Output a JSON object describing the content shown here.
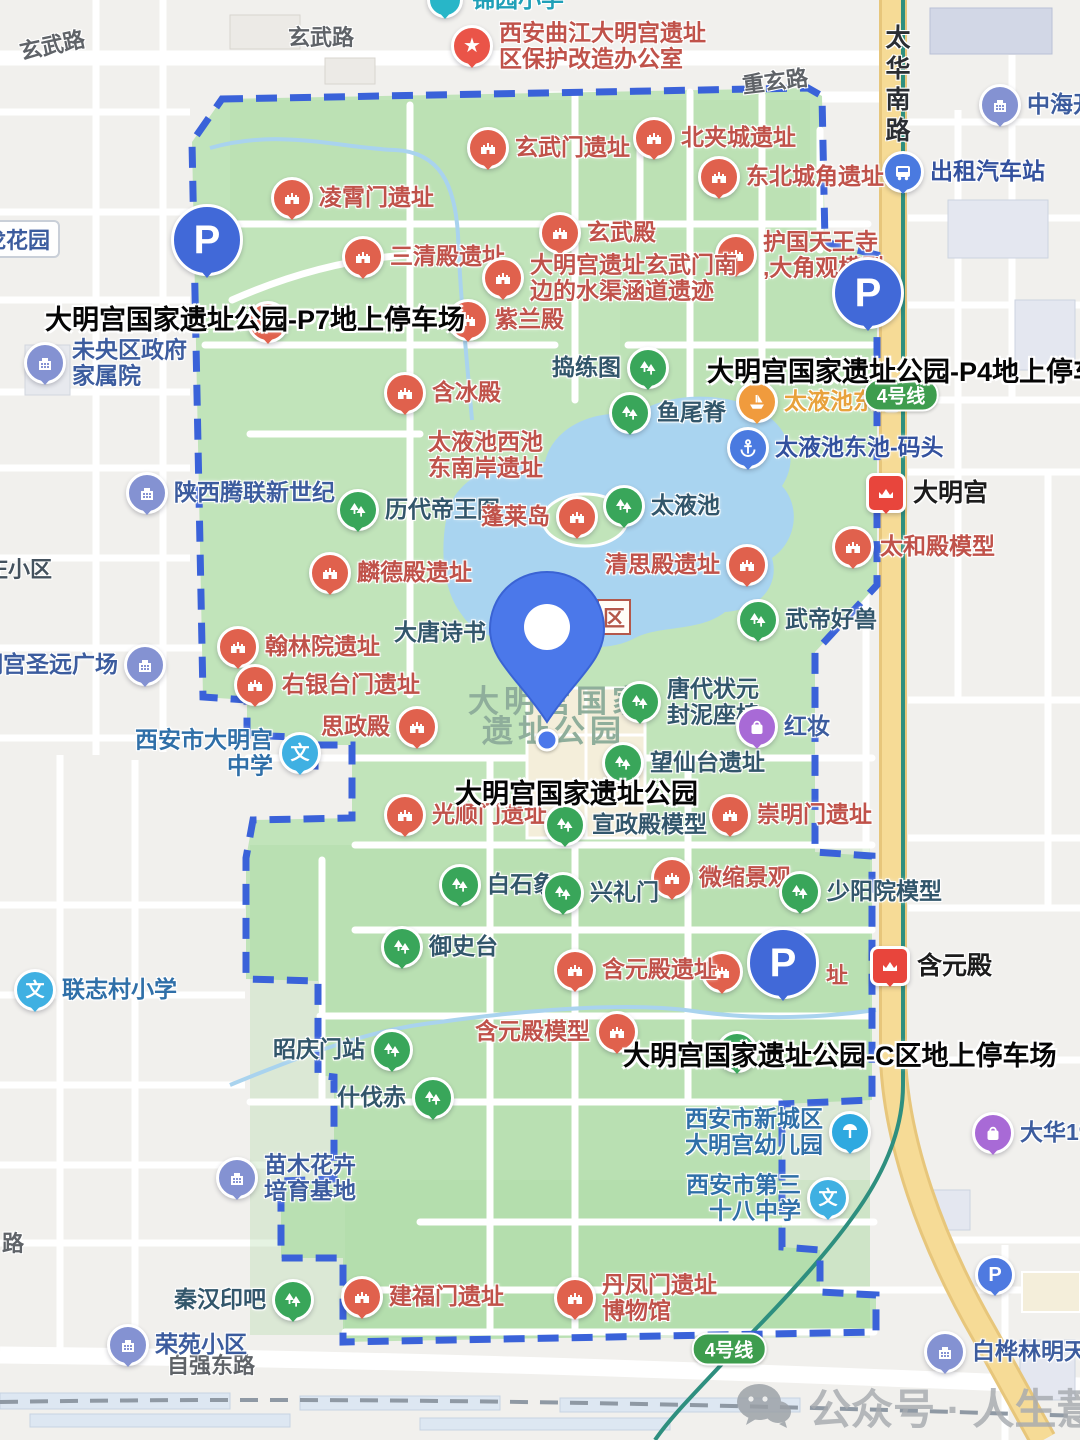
{
  "map_title": "大明宫国家遗址公园地图",
  "colors": {
    "park_green": "#c1e4ba",
    "border_blue": "#3a62d9",
    "water": "#a9d4f0",
    "road_yellow": "#f6db96",
    "metro_teal": "#2e8f7f",
    "badge_green": "#3e9d4e",
    "ruin_pin": "#e0614d",
    "scenic_pin": "#39a65a",
    "parking_pin": "#4169d8"
  },
  "location_pin": {
    "x": 547,
    "y": 632,
    "tip_x": 547,
    "tip_y": 722,
    "dot_x": 547,
    "dot_y": 740
  },
  "area_label": {
    "line1": "大明宫国家",
    "line2": "遗址公园",
    "x1": 468,
    "y1": 676,
    "x2": 482,
    "y2": 706
  },
  "bold_labels": [
    {
      "id": "p7-parking-name",
      "text": "大明宫国家遗址公园-P7地上停车场",
      "x": 45,
      "y": 298
    },
    {
      "id": "p4-parking-name",
      "text": "大明宫国家遗址公园-P4地上停车场",
      "x": 707,
      "y": 350
    },
    {
      "id": "park-name",
      "text": "大明宫国家遗址公园",
      "x": 455,
      "y": 772
    },
    {
      "id": "c-parking-name",
      "text": "大明宫国家遗址公园-C区地上停车场",
      "x": 623,
      "y": 1034
    }
  ],
  "road_labels": [
    {
      "id": "xuanwu-rd-west",
      "text": "玄武路",
      "x": 19,
      "y": 28,
      "rot": -12
    },
    {
      "id": "xuanwu-rd-center",
      "text": "玄武路",
      "x": 288,
      "y": 20,
      "rot": 0
    },
    {
      "id": "chongxuan-rd",
      "text": "重玄路",
      "x": 742,
      "y": 64,
      "rot": -7
    },
    {
      "id": "taihua-south-rd",
      "text": "太华南路",
      "x": 878,
      "y": 24,
      "vertical": true
    },
    {
      "id": "ziqiang-east-rd",
      "text": "自强东路",
      "x": 167,
      "y": 1348,
      "rot": 0
    },
    {
      "id": "road-fragment",
      "text": "路",
      "x": 2,
      "y": 1226,
      "rot": 0
    }
  ],
  "badges": [
    {
      "id": "line4-badge-north",
      "text": "4号线",
      "x": 901,
      "y": 395
    },
    {
      "id": "line4-badge-south",
      "text": "4号线",
      "x": 729,
      "y": 1349
    }
  ],
  "fragments": [
    {
      "id": "scenic-zone-fragment",
      "text": "区",
      "x": 597,
      "y": 599,
      "boxed": true
    },
    {
      "id": "covered-ruin-fragment",
      "text": "址",
      "x": 826,
      "y": 958,
      "boxed": false
    }
  ],
  "edge_labels": [
    {
      "id": "longhuayuan",
      "text": "龙花园",
      "x": -26,
      "y": 220,
      "boxed": true
    },
    {
      "id": "zhuang-xiaoqu",
      "text": "庄小区",
      "x": -14,
      "y": 552,
      "boxed": false
    }
  ],
  "watermark": {
    "text": "公众号 · 人生薏林",
    "x": 735,
    "y": 1376
  },
  "pois": [
    {
      "id": "jinyuan-primary-school",
      "t": "cyan",
      "x": 445,
      "y": 0,
      "s": "right",
      "l": [
        "锦园小学"
      ]
    },
    {
      "id": "daminggong-protection-office",
      "t": "star",
      "x": 472,
      "y": 46,
      "s": "right",
      "l": [
        "西安曲江大明宫遗址",
        "区保护改造办公室"
      ]
    },
    {
      "id": "zhonghai-kai",
      "t": "building",
      "x": 1000,
      "y": 105,
      "s": "right",
      "l": [
        "中海开"
      ]
    },
    {
      "id": "taxi-station",
      "t": "bus",
      "x": 903,
      "y": 172,
      "s": "right",
      "l": [
        "出租汽车站"
      ]
    },
    {
      "id": "beijiacheng-ruins",
      "t": "ruin",
      "x": 654,
      "y": 138,
      "s": "right",
      "l": [
        "北夹城遗址"
      ]
    },
    {
      "id": "northeast-corner-ruins",
      "t": "ruin",
      "x": 719,
      "y": 177,
      "s": "right",
      "l": [
        "东北城角遗址"
      ]
    },
    {
      "id": "xuanwumen-ruins",
      "t": "ruin",
      "x": 488,
      "y": 148,
      "s": "right",
      "l": [
        "玄武门遗址"
      ]
    },
    {
      "id": "lingxiaomen-ruins",
      "t": "ruin",
      "x": 292,
      "y": 198,
      "s": "right",
      "l": [
        "凌霄门遗址"
      ]
    },
    {
      "id": "xuanwu-hall",
      "t": "ruin",
      "x": 560,
      "y": 233,
      "s": "right",
      "l": [
        "玄武殿"
      ]
    },
    {
      "id": "sanqing-hall-ruins",
      "t": "ruin",
      "x": 363,
      "y": 257,
      "s": "right",
      "l": [
        "三清殿遗址"
      ]
    },
    {
      "id": "huguo-tianwang-temple",
      "t": "ruin",
      "x": 736,
      "y": 255,
      "s": "right",
      "l": [
        "护国天王寺",
        ",大角观模型"
      ]
    },
    {
      "id": "water-channel-ruins",
      "t": "ruin",
      "x": 503,
      "y": 278,
      "s": "right",
      "l": [
        "大明宫遗址玄武门南",
        "边的水渠涵道遗迹"
      ]
    },
    {
      "id": "zilan-hall",
      "t": "ruin",
      "x": 468,
      "y": 320,
      "s": "right",
      "l": [
        "紫兰殿"
      ]
    },
    {
      "id": "hidden-ruin-p7",
      "t": "ruin",
      "x": 268,
      "y": 322,
      "s": "none",
      "l": [],
      "hidden": true
    },
    {
      "id": "hanbing-hall",
      "t": "ruin",
      "x": 405,
      "y": 393,
      "s": "right",
      "l": [
        "含冰殿"
      ]
    },
    {
      "id": "weiyang-gov-compound",
      "t": "building",
      "x": 45,
      "y": 363,
      "s": "right",
      "l": [
        "未央区政府",
        "家属院"
      ]
    },
    {
      "id": "daolian-painting",
      "t": "scenic",
      "x": 648,
      "y": 368,
      "s": "left",
      "l": [
        "捣练图"
      ]
    },
    {
      "id": "yuweiji",
      "t": "scenic",
      "x": 630,
      "y": 413,
      "s": "right",
      "l": [
        "鱼尾脊"
      ]
    },
    {
      "id": "taiye-east-pool",
      "t": "boat",
      "x": 757,
      "y": 402,
      "s": "right",
      "l": [
        "太液池东池"
      ]
    },
    {
      "id": "taiye-east-pool-pier",
      "t": "anchor",
      "x": 748,
      "y": 448,
      "s": "right",
      "l": [
        "太液池东池-码头"
      ]
    },
    {
      "id": "daminggong-metro",
      "t": "metro",
      "x": 886,
      "y": 493,
      "s": "right",
      "l": [
        "大明宫"
      ]
    },
    {
      "id": "shanxi-tenglian",
      "t": "building",
      "x": 147,
      "y": 493,
      "s": "right",
      "l": [
        "陕西腾联新世纪"
      ]
    },
    {
      "id": "emperors-painting",
      "t": "scenic",
      "x": 358,
      "y": 510,
      "s": "right",
      "l": [
        "历代帝王图"
      ]
    },
    {
      "id": "penglai-island",
      "t": "ruin",
      "x": 577,
      "y": 517,
      "s": "left",
      "l": [
        "蓬莱岛"
      ]
    },
    {
      "id": "taiye-pool",
      "t": "scenic",
      "x": 624,
      "y": 506,
      "s": "right",
      "l": [
        "太液池"
      ]
    },
    {
      "id": "taiye-west-pool-ruins",
      "t": "text",
      "x": 428,
      "y": 455,
      "s": "none",
      "l": [
        "太液池西池",
        "东南岸遗址"
      ],
      "c": "ruin"
    },
    {
      "id": "taihe-hall-model",
      "t": "ruin",
      "x": 853,
      "y": 547,
      "s": "right",
      "l": [
        "太和殿模型"
      ]
    },
    {
      "id": "linde-hall-ruins",
      "t": "ruin",
      "x": 330,
      "y": 573,
      "s": "right",
      "l": [
        "麟德殿遗址"
      ]
    },
    {
      "id": "qingsi-hall-ruins",
      "t": "ruin",
      "x": 747,
      "y": 565,
      "s": "left",
      "l": [
        "清思殿遗址"
      ]
    },
    {
      "id": "wudi-haoshou",
      "t": "scenic",
      "x": 758,
      "y": 620,
      "s": "right",
      "l": [
        "武帝好兽"
      ]
    },
    {
      "id": "datang-poetry",
      "t": "scenic",
      "x": 513,
      "y": 633,
      "s": "left",
      "l": [
        "大唐诗书"
      ],
      "hidden": true
    },
    {
      "id": "hanlin-academy-ruins",
      "t": "ruin",
      "x": 238,
      "y": 647,
      "s": "right",
      "l": [
        "翰林院遗址"
      ]
    },
    {
      "id": "youyintai-gate-ruins",
      "t": "ruin",
      "x": 255,
      "y": 685,
      "s": "right",
      "l": [
        "右银台门遗址"
      ]
    },
    {
      "id": "shengyuan-plaza",
      "t": "building",
      "x": 145,
      "y": 665,
      "s": "left",
      "l": [
        "大明宫圣远广场"
      ]
    },
    {
      "id": "zhuangyuan-seal-seat",
      "t": "scenic",
      "x": 640,
      "y": 702,
      "s": "right",
      "l": [
        "唐代状元",
        "封泥座椅"
      ]
    },
    {
      "id": "sizheng-hall",
      "t": "ruin",
      "x": 417,
      "y": 727,
      "s": "left",
      "l": [
        "思政殿"
      ]
    },
    {
      "id": "hongzhuang-shop",
      "t": "shop",
      "x": 757,
      "y": 727,
      "s": "right",
      "l": [
        "红妆"
      ]
    },
    {
      "id": "wangxiantai-ruins",
      "t": "scenic",
      "x": 623,
      "y": 763,
      "s": "right",
      "l": [
        "望仙台遗址"
      ]
    },
    {
      "id": "daminggong-middle-school",
      "t": "school",
      "x": 300,
      "y": 753,
      "s": "left",
      "l": [
        "西安市大明宫",
        "中学"
      ]
    },
    {
      "id": "guangshunmen-ruins",
      "t": "ruin",
      "x": 405,
      "y": 815,
      "s": "right",
      "l": [
        "光顺门遗址"
      ]
    },
    {
      "id": "chongmingmen-ruins",
      "t": "ruin",
      "x": 730,
      "y": 815,
      "s": "right",
      "l": [
        "崇明门遗址"
      ]
    },
    {
      "id": "xuanzheng-hall-model",
      "t": "scenic",
      "x": 565,
      "y": 825,
      "s": "right",
      "l": [
        "宣政殿模型"
      ]
    },
    {
      "id": "miniature-landscape",
      "t": "ruin",
      "x": 672,
      "y": 878,
      "s": "right",
      "l": [
        "微缩景观"
      ]
    },
    {
      "id": "shaoyangyuan-model",
      "t": "scenic",
      "x": 800,
      "y": 892,
      "s": "right",
      "l": [
        "少阳院模型"
      ]
    },
    {
      "id": "white-stone-elephant",
      "t": "scenic",
      "x": 460,
      "y": 885,
      "s": "right",
      "l": [
        "白石象"
      ]
    },
    {
      "id": "xinglimen",
      "t": "scenic",
      "x": 563,
      "y": 893,
      "s": "right",
      "l": [
        "兴礼门"
      ]
    },
    {
      "id": "yushitai",
      "t": "scenic",
      "x": 402,
      "y": 947,
      "s": "right",
      "l": [
        "御史台"
      ]
    },
    {
      "id": "hanyuan-hall-ruins",
      "t": "ruin",
      "x": 575,
      "y": 970,
      "s": "right",
      "l": [
        "含元殿遗址"
      ]
    },
    {
      "id": "hidden-ruin-c",
      "t": "ruin",
      "x": 722,
      "y": 972,
      "s": "none",
      "l": [],
      "hidden": true
    },
    {
      "id": "hanyuan-hall-metro",
      "t": "metro",
      "x": 890,
      "y": 966,
      "s": "right",
      "l": [
        "含元殿"
      ]
    },
    {
      "id": "lianzhi-village-school",
      "t": "school",
      "x": 35,
      "y": 990,
      "s": "right",
      "l": [
        "联志村小学"
      ]
    },
    {
      "id": "hanyuan-hall-model",
      "t": "ruin",
      "x": 617,
      "y": 1032,
      "s": "left",
      "l": [
        "含元殿模型"
      ]
    },
    {
      "id": "zhaoqingmen-station",
      "t": "scenic",
      "x": 392,
      "y": 1050,
      "s": "left",
      "l": [
        "昭庆门站"
      ]
    },
    {
      "id": "hidden-scenic-c",
      "t": "scenic",
      "x": 737,
      "y": 1052,
      "s": "none",
      "l": [],
      "hidden": true
    },
    {
      "id": "shifachi",
      "t": "scenic",
      "x": 433,
      "y": 1098,
      "s": "left",
      "l": [
        "什伐赤"
      ]
    },
    {
      "id": "daminggong-kindergarten",
      "t": "kind",
      "x": 850,
      "y": 1132,
      "s": "left",
      "l": [
        "西安市新城区",
        "大明宫幼儿园"
      ]
    },
    {
      "id": "dahua-19",
      "t": "shop",
      "x": 993,
      "y": 1133,
      "s": "right",
      "l": [
        "大华19"
      ]
    },
    {
      "id": "seedling-flower-base",
      "t": "building",
      "x": 237,
      "y": 1178,
      "s": "right",
      "l": [
        "苗木花卉",
        "培育基地"
      ]
    },
    {
      "id": "no38-middle-school",
      "t": "school",
      "x": 828,
      "y": 1198,
      "s": "left",
      "l": [
        "西安市第三",
        "十八中学"
      ]
    },
    {
      "id": "small-parking",
      "t": "parkS",
      "x": 995,
      "y": 1275,
      "s": "none",
      "l": []
    },
    {
      "id": "jianfumen-ruins",
      "t": "ruin",
      "x": 362,
      "y": 1297,
      "s": "right",
      "l": [
        "建福门遗址"
      ]
    },
    {
      "id": "qinhan-seal-bar",
      "t": "scenic",
      "x": 293,
      "y": 1300,
      "s": "left",
      "l": [
        "秦汉印吧"
      ]
    },
    {
      "id": "danfengmen-museum",
      "t": "ruin",
      "x": 575,
      "y": 1298,
      "s": "right",
      "l": [
        "丹凤门遗址",
        "博物馆"
      ]
    },
    {
      "id": "rongyuan-community",
      "t": "building",
      "x": 128,
      "y": 1345,
      "s": "right",
      "l": [
        "荣苑小区"
      ]
    },
    {
      "id": "baihualin-mingtian",
      "t": "building",
      "x": 945,
      "y": 1352,
      "s": "right",
      "l": [
        "白桦林明天"
      ]
    },
    {
      "id": "p7-parking",
      "t": "parkL",
      "x": 207,
      "y": 240,
      "s": "none",
      "l": [
        "P"
      ]
    },
    {
      "id": "p4-parking",
      "t": "parkL",
      "x": 868,
      "y": 293,
      "s": "none",
      "l": [
        "P"
      ]
    },
    {
      "id": "c-zone-parking",
      "t": "parkL",
      "x": 783,
      "y": 963,
      "s": "none",
      "l": [
        "P"
      ]
    }
  ]
}
